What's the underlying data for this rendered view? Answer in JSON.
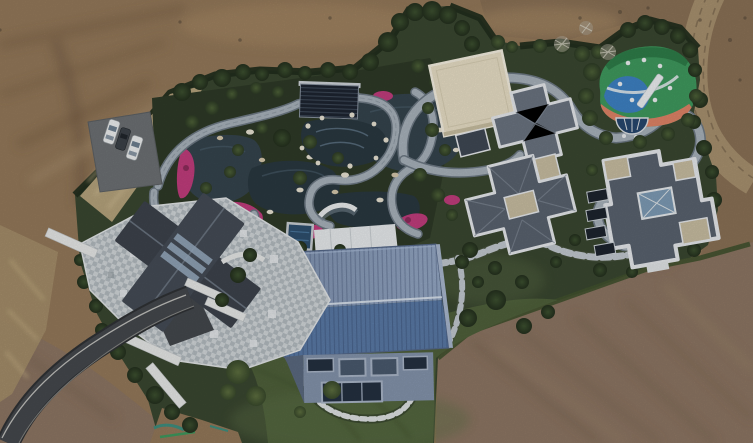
{
  "scene": {
    "kind": "aerial drone photograph",
    "subject": "Aerial view of a landscaped estate compound with pond garden, playground and several residences surrounded by bare graded earth",
    "visible_features": [
      "bare brown earth surrounding the walled compound",
      "dark perimeter hedge and tree line",
      "gray parking pad with three parked cars",
      "curving dark asphalt driveway at lower left",
      "stone-paved house with dark cross-gable roof",
      "koi pond garden with winding light stone paths",
      "magenta azalea flower beds and white edge rocks",
      "dark slatted pergola over a stepping-stone pool",
      "cream flat-roof pavilion",
      "multicolor rubber playground with white slide",
      "two gray hip-roof mansions with white parapets and tan roof decks",
      "large hall with two-tone ribbed blue metal roof and glass facade",
      "small square plunge pool, white terrace and arched bridge",
      "dirt service road at upper right",
      "teal and green paint marks on dirt at bottom left"
    ]
  },
  "counts": {
    "cars": 3,
    "mansions": 2,
    "ponds": 4,
    "playgrounds": 1,
    "roads": 2
  },
  "palette": {
    "dirt_top": "#94795a",
    "dirt_dark": "#755c43",
    "dirt_right": "#8a7156",
    "dirt_bottom": "#8d7663",
    "dirt_track": "#a8916f",
    "dirt_light": "#a98c66",
    "compound_green": "#3a4730",
    "garden_dark": "#2e3a27",
    "lawn": "#4f613b",
    "lawn_light": "#5d7046",
    "hedge": "#222e1d",
    "tree_bare": "#b6b1a3",
    "dry_grass": "#c4ae86",
    "dry_grass_dark": "#a6906c",
    "path_gray": "#a9b3bc",
    "path_edge": "#6e7a85",
    "pond": "#35444d",
    "pond_deep": "#2a3840",
    "flower_pink": "#c23d7d",
    "flower_deep": "#8e2c5c",
    "rock_white": "#e9e3d3",
    "rock_tan": "#d6c8ac",
    "asphalt": "#45484d",
    "asphalt_dark": "#2f3235",
    "road_line": "#d8d8d2",
    "parking_gray": "#6d7174",
    "car_white": "#eef0f1",
    "car_dark": "#3c4248",
    "car_glass": "#6e8091",
    "pergola_dark": "#1d2430",
    "pavilion_cream": "#e9dfc6",
    "pavilion_edge": "#f6f1e2",
    "pavilion_shadow": "#c9bfa2",
    "play_green": "#3f9a5e",
    "play_green_dark": "#2e7d49",
    "play_blue": "#3e82c4",
    "play_salmon": "#e08467",
    "play_red": "#bf4a39",
    "play_navy": "#27476e",
    "play_white": "#eef1f3",
    "mansion_roof": "#5a636f",
    "mansion_roof_light": "#6b7481",
    "mansion_edge": "#e7eaed",
    "mansion_tan": "#c9bea2",
    "skylight_blue": "#7e9cb6",
    "well_dark": "#1d242e",
    "blue_roof": "#7e91af",
    "blue_roof_light": "#95a8c5",
    "blue_roof_low": "#5a7aa6",
    "blue_roof_dark": "#66789a",
    "roof_ridge": "#dfe8f2",
    "facade": "#8494ac",
    "window_dark": "#243040",
    "window_mid": "#4a5a6e",
    "window_frame": "#aab6c8",
    "paving_light": "#d2d7da",
    "paving_mid": "#b4bcc1",
    "paving_white": "#e9ecee",
    "house_roof": "#3d434c",
    "house_roof2": "#454c56",
    "house_ridge": "#6a7480",
    "skylight_strip": "#9db1c6",
    "terrace": "#d8dcdf",
    "pool_blue": "#2e4f6e",
    "pool_line": "#4c7aa0",
    "paint_teal": "#3f8f7f",
    "paint_green": "#3f9a5e"
  }
}
